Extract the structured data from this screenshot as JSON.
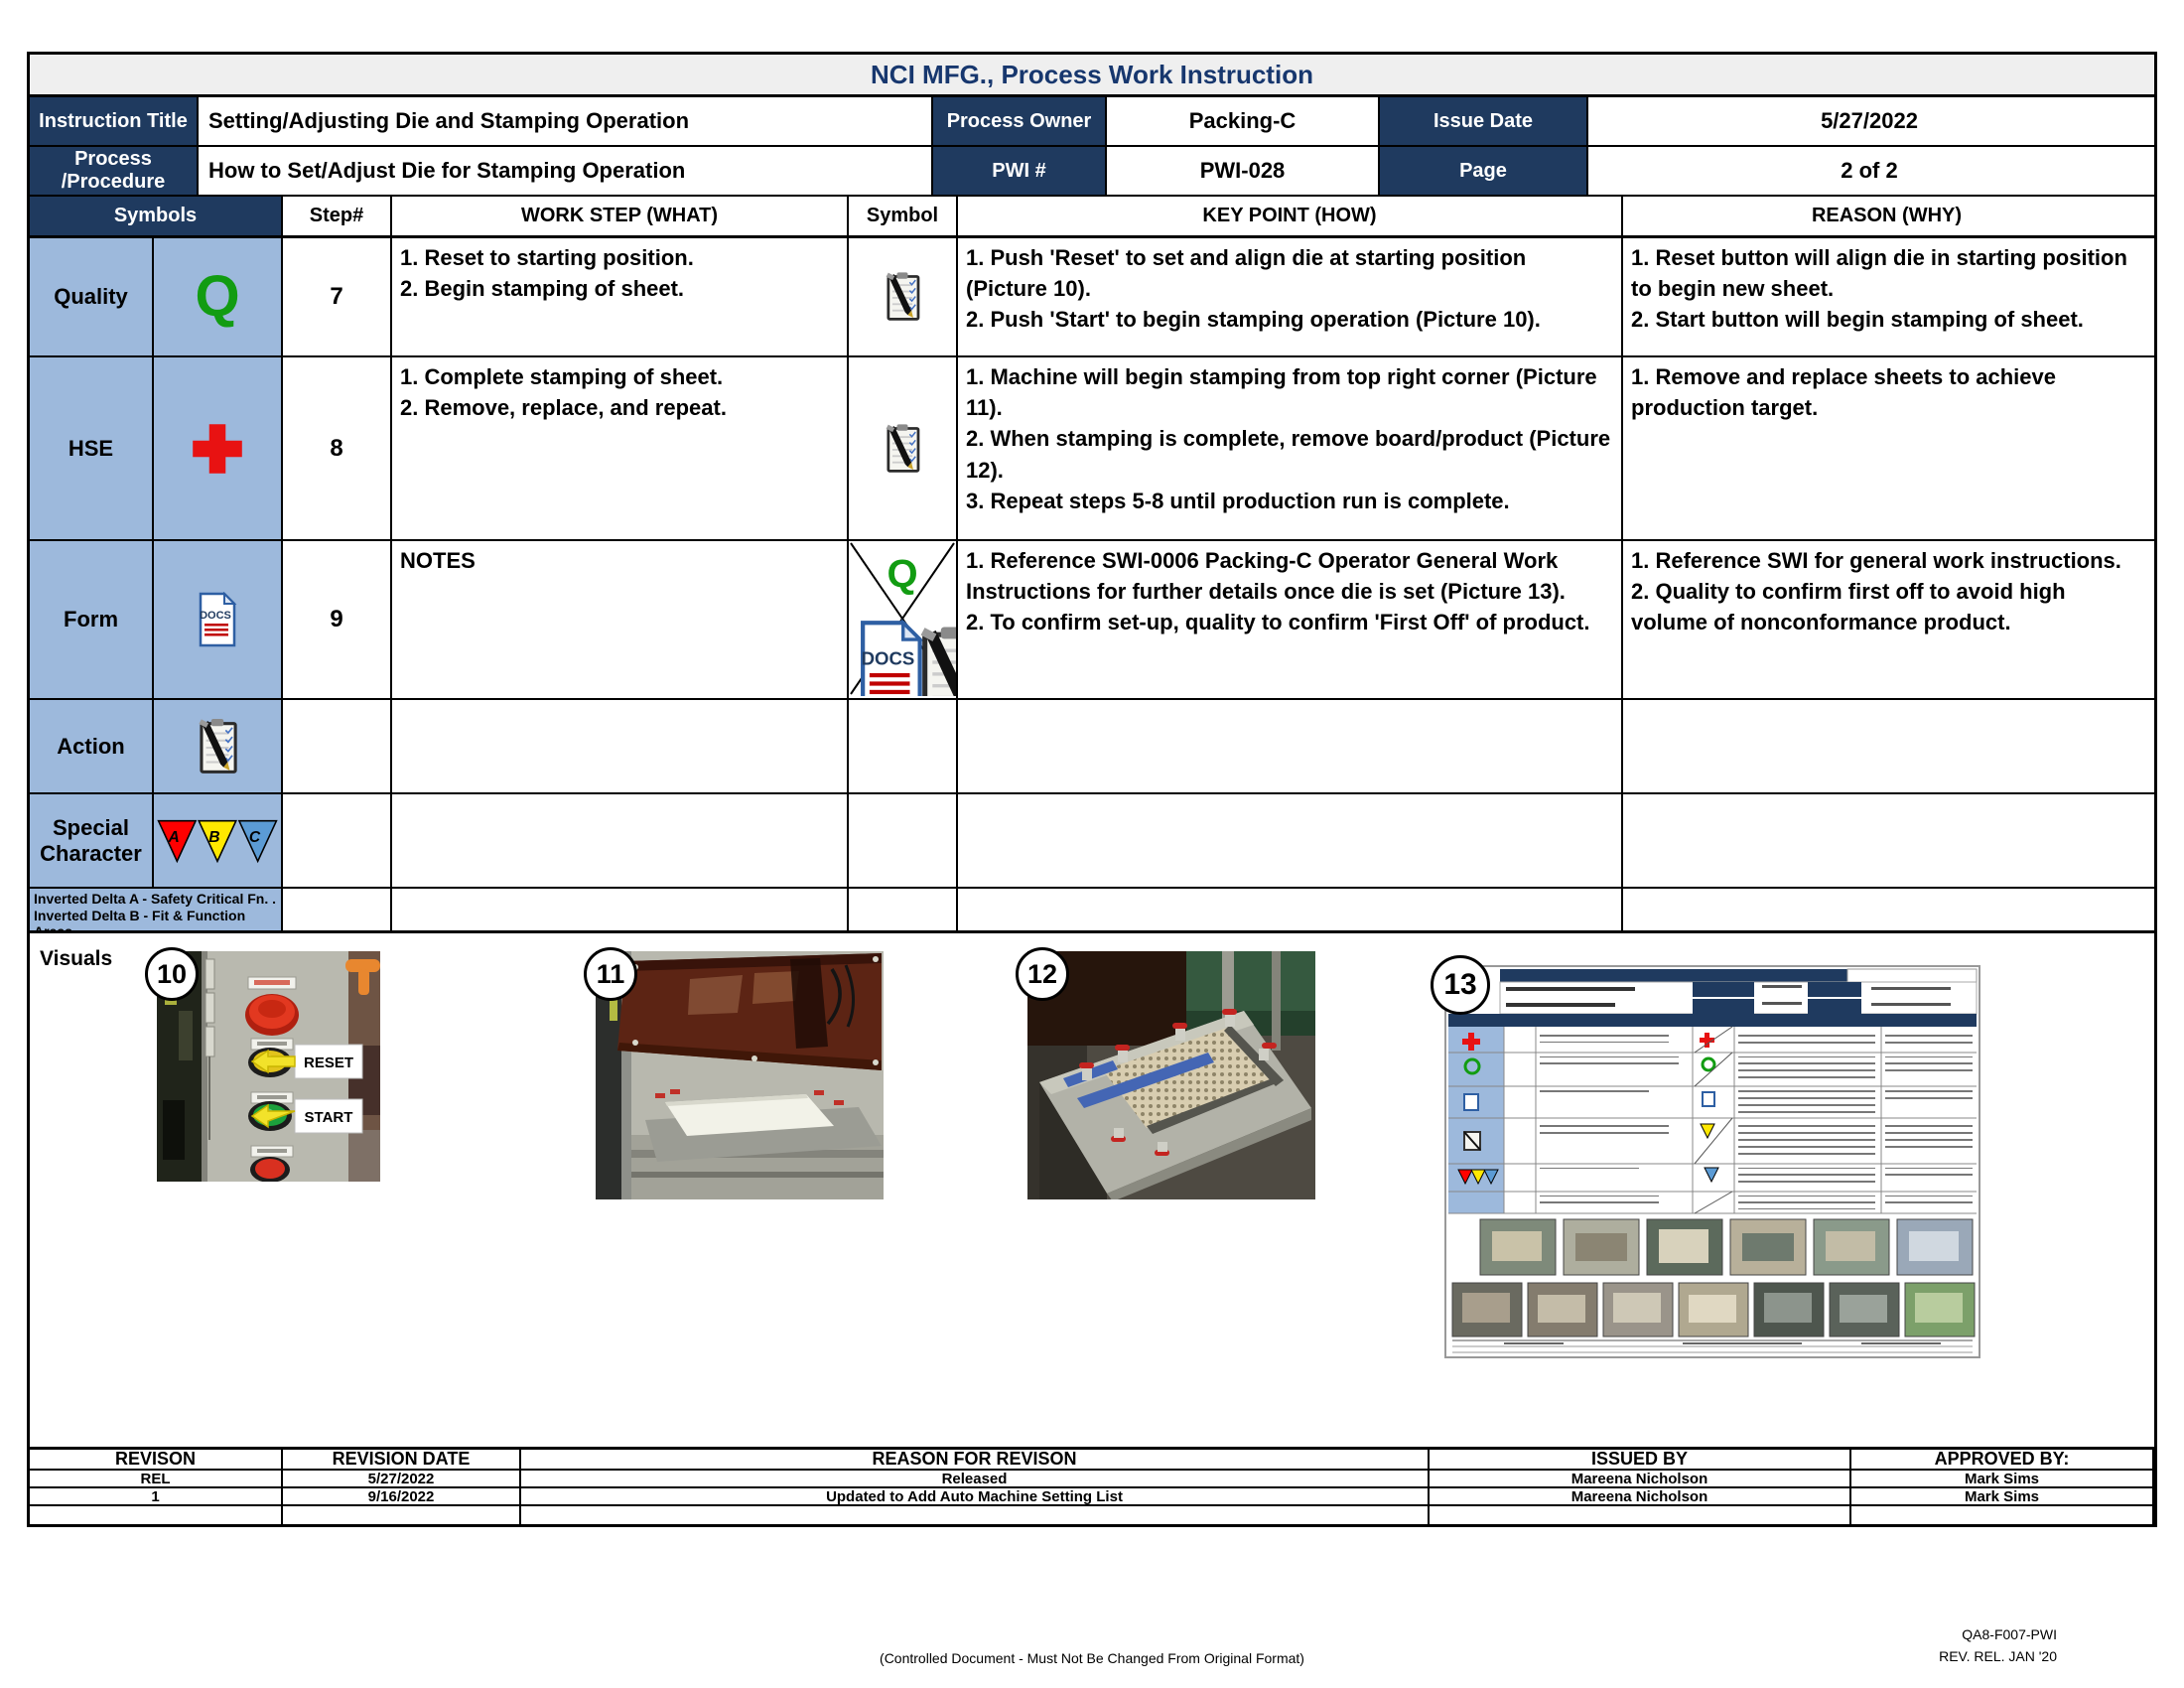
{
  "header": {
    "doc_title": "NCI MFG., Process Work Instruction",
    "row1": [
      {
        "label": "Instruction Title",
        "value": "Setting/Adjusting Die and Stamping Operation"
      },
      {
        "label": "Process Owner",
        "value": "Packing-C"
      },
      {
        "label": "Issue Date",
        "value": "5/27/2022"
      }
    ],
    "row2": [
      {
        "label": "Process /Procedure",
        "value": "How to Set/Adjust Die for Stamping Operation"
      },
      {
        "label": "PWI #",
        "value": "PWI-028"
      },
      {
        "label": "Page",
        "value": "2 of 2"
      }
    ]
  },
  "table": {
    "columns": {
      "symbols": "Symbols",
      "step": "Step#",
      "work": "WORK STEP (WHAT)",
      "symbol": "Symbol",
      "key": "KEY POINT (HOW)",
      "reason": "REASON (WHY)"
    },
    "symbol_rows": [
      {
        "label": "Quality",
        "icon": "quality-q-icon"
      },
      {
        "label": "HSE",
        "icon": "first-aid-cross-icon"
      },
      {
        "label": "Form",
        "icon": "docs-document-icon"
      },
      {
        "label": "Action",
        "icon": "clipboard-pen-icon"
      },
      {
        "label": "Special Character",
        "icon": "inverted-delta-triangles-icon"
      }
    ],
    "legend": [
      "Inverted Delta A - Safety Critical Fn. .",
      "Inverted Delta B - Fit & Function Areas",
      "Inverted Delta C  - Appearance Non -Fn."
    ],
    "steps": [
      {
        "num": "7",
        "work": "1. Reset to starting position.\n2. Begin stamping of sheet.",
        "key": "1. Push 'Reset' to set and align die at starting position (Picture 10).\n2. Push 'Start' to begin stamping operation (Picture 10).",
        "reason": "1. Reset button will align die in starting position to begin new sheet.\n2. Start button will begin stamping of sheet."
      },
      {
        "num": "8",
        "work": "1. Complete stamping of sheet.\n2. Remove, replace, and repeat.",
        "key": "1. Machine will begin stamping from top right corner (Picture 11).\n2. When stamping is complete, remove board/product (Picture 12).\n3. Repeat steps 5-8 until production run is complete.",
        "reason": "1. Remove and replace sheets to achieve production target."
      },
      {
        "num": "9",
        "work": "NOTES",
        "key": "1. Reference SWI-0006 Packing-C Operator General Work Instructions for further details once die is set (Picture 13).\n2. To confirm set-up, quality to confirm 'First Off' of product.",
        "reason": "1. Reference SWI for general work instructions.\n2. Quality to confirm first off to avoid high volume of nonconformance product."
      }
    ]
  },
  "icons": {
    "quality_letter": "Q",
    "docs_text": "DOCS",
    "delta_a": "A",
    "delta_b": "B",
    "delta_c": "C"
  },
  "visuals": {
    "label": "Visuals",
    "pics": [
      {
        "num": "10",
        "annotations": [
          "RESET",
          "START"
        ]
      },
      {
        "num": "11"
      },
      {
        "num": "12"
      },
      {
        "num": "13"
      }
    ]
  },
  "revisions": {
    "headers": [
      "REVISON",
      "REVISION DATE",
      "REASON FOR REVISON",
      "ISSUED BY",
      "APPROVED BY:"
    ],
    "rows": [
      [
        "REL",
        "5/27/2022",
        "Released",
        "Mareena Nicholson",
        "Mark Sims"
      ],
      [
        "1",
        "9/16/2022",
        "Updated to Add Auto Machine Setting List",
        "Mareena Nicholson",
        "Mark Sims"
      ],
      [
        "",
        "",
        "",
        "",
        ""
      ]
    ]
  },
  "footer": {
    "controlled": "(Controlled Document - Must Not Be Changed From Original Format)",
    "doc_code": "QA8-F007-PWI",
    "rev": "REV. REL. JAN '20"
  },
  "colors": {
    "navy": "#1F3A5F",
    "light_blue": "#9DB9DC",
    "quality_green": "#129C12",
    "hse_red": "#E81212",
    "delta_a_red": "#FF0000",
    "delta_b_yellow": "#FFE800",
    "delta_c_blue": "#5B9BD5",
    "titlebar_gray": "#EFEFEF"
  }
}
